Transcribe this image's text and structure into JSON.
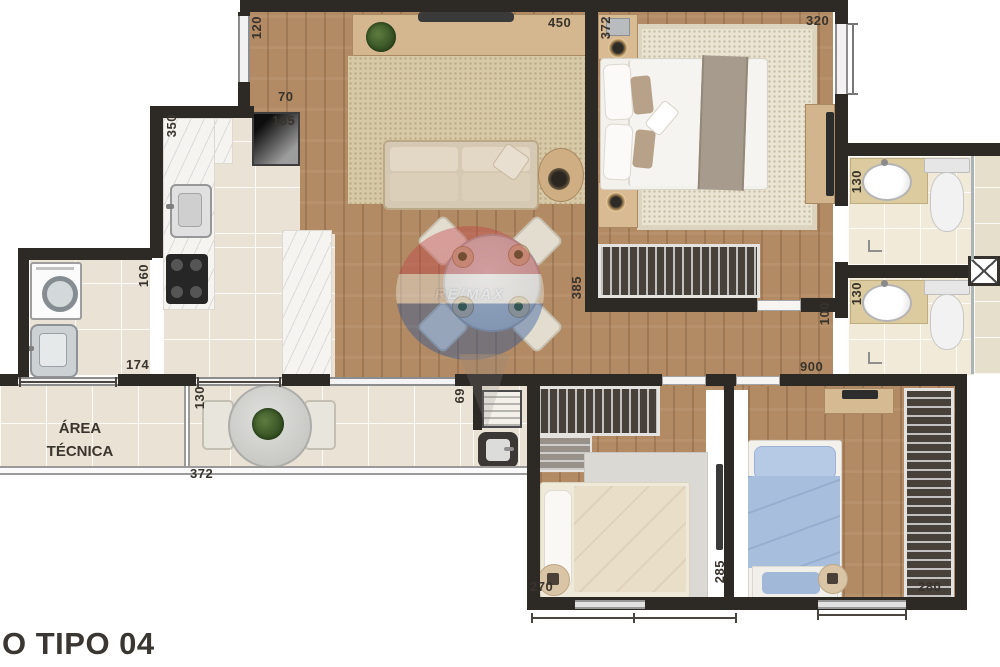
{
  "title": "O TIPO 04",
  "watermark_text": "RE/MAX",
  "rooms": {
    "area_tecnica": {
      "line1": "ÁREA",
      "line2": "TÉCNICA"
    }
  },
  "dims": {
    "win_left": "120",
    "living_top": "450",
    "bed1_top": "372",
    "bed1_win": "320",
    "kitchen_70": "70",
    "kitchen_185": "185",
    "kitchen_350": "350",
    "kitchen_160": "160",
    "living_385": "385",
    "bath1_130": "130",
    "bath2_130": "130",
    "hall_100": "100",
    "laundry_174": "174",
    "balcony_130": "130",
    "balcony_372": "372",
    "gourmet_69": "69",
    "hall_900": "900",
    "bed2_270": "270",
    "bed2_285": "285",
    "bed3_280": "280"
  },
  "colors": {
    "wall": "#2d2a26",
    "wood_floor": "#b28a63",
    "tile_floor": "#eae2d4",
    "bath_floor": "#f2ead8",
    "blue_bed": "#a7bedd",
    "watermark_red": "#c23e43",
    "watermark_blue": "#24539b"
  }
}
